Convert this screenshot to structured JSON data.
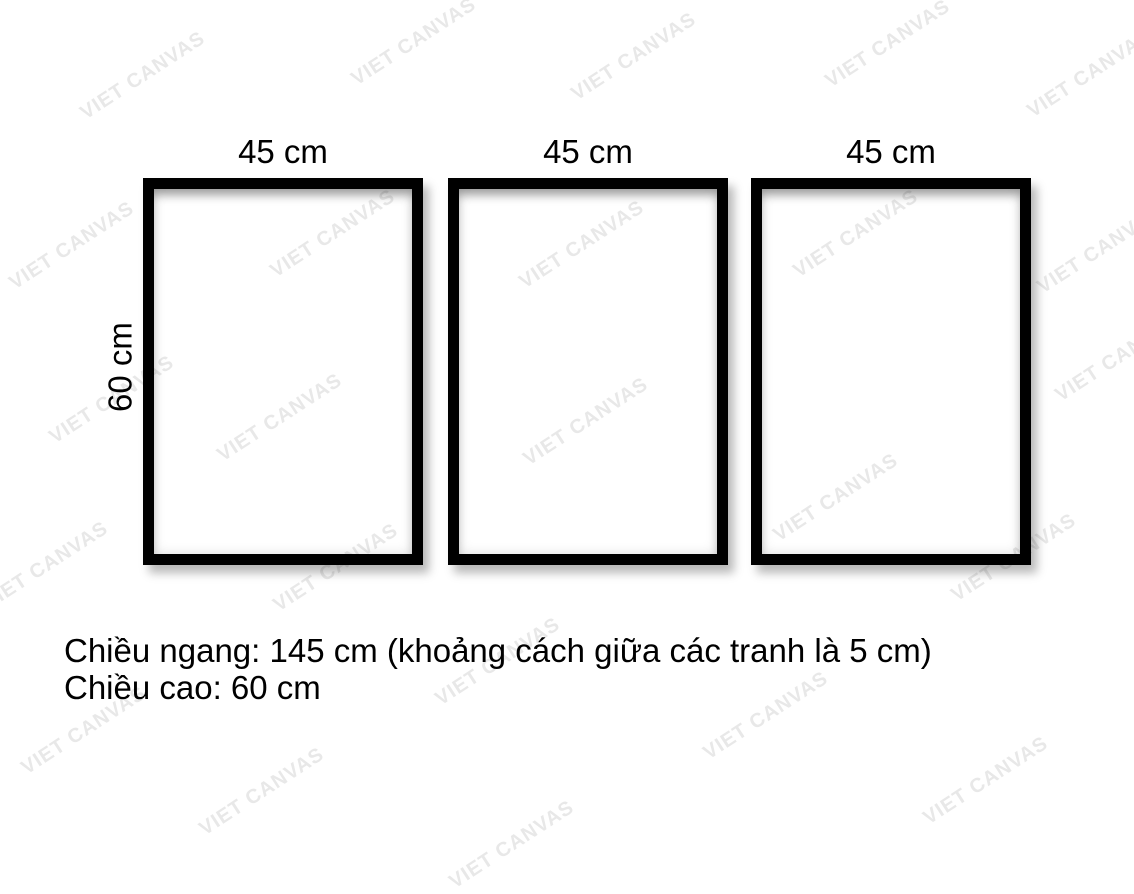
{
  "diagram": {
    "frames": [
      {
        "width_label": "45 cm"
      },
      {
        "width_label": "45 cm"
      },
      {
        "width_label": "45 cm"
      }
    ],
    "height_label": "60 cm"
  },
  "caption": {
    "line1": "Chiều ngang: 145 cm (khoảng cách giữa các tranh là 5 cm)",
    "line2": "Chiều cao: 60 cm"
  },
  "watermark": {
    "text": "VIET CANVAS",
    "color": "#e8e8e8",
    "angle_deg": -33,
    "positions": [
      [
        143,
        76
      ],
      [
        414,
        42
      ],
      [
        634,
        57
      ],
      [
        888,
        44
      ],
      [
        1090,
        74
      ],
      [
        72,
        246
      ],
      [
        333,
        234
      ],
      [
        582,
        245
      ],
      [
        856,
        234
      ],
      [
        1100,
        250
      ],
      [
        112,
        400
      ],
      [
        280,
        418
      ],
      [
        586,
        422
      ],
      [
        836,
        498
      ],
      [
        1014,
        558
      ],
      [
        1118,
        358
      ],
      [
        46,
        566
      ],
      [
        336,
        568
      ],
      [
        498,
        662
      ],
      [
        766,
        716
      ],
      [
        84,
        731
      ],
      [
        262,
        792
      ],
      [
        512,
        845
      ],
      [
        986,
        781
      ]
    ]
  },
  "colors": {
    "background": "#ffffff",
    "frame_border": "#000000",
    "text": "#000000"
  }
}
